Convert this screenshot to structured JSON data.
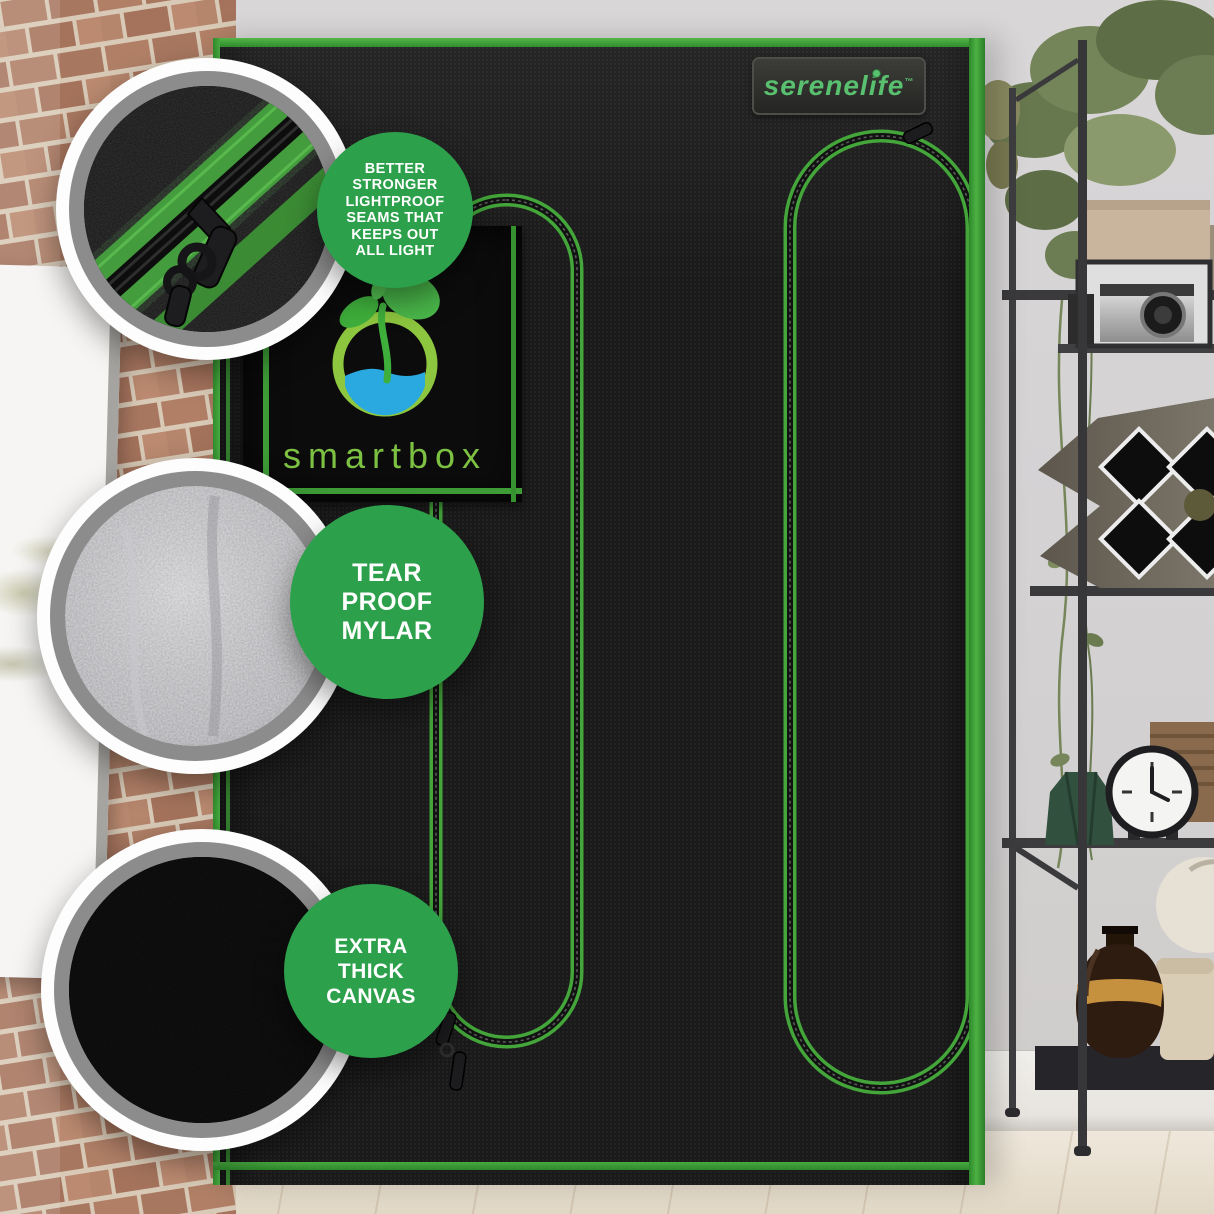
{
  "image_type": "product-marketing-photo",
  "brand": {
    "logo_text": "serenelife",
    "trademark": "™"
  },
  "tent_patch": {
    "logo_text": "smartbox",
    "icon": "plant-sprout-in-ring-icon"
  },
  "callouts": [
    {
      "id": "lightproof-seams",
      "swatch": "zipper-seam-closeup",
      "lines": [
        "BETTER",
        "STRONGER",
        "LIGHTPROOF",
        "SEAMS THAT",
        "KEEPS OUT",
        "ALL LIGHT"
      ]
    },
    {
      "id": "tear-proof-mylar",
      "swatch": "silver-mylar-texture",
      "lines": [
        "TEAR",
        "PROOF",
        "MYLAR"
      ]
    },
    {
      "id": "extra-thick-canvas",
      "swatch": "black-canvas-texture",
      "lines": [
        "EXTRA",
        "THICK",
        "CANVAS"
      ]
    }
  ],
  "colors": {
    "callout_green": "#2da04b",
    "tent_trim_green": "#3fa338",
    "zipper_tape_green": "#4fae44",
    "logo_text_green": "#7cc142",
    "serenelife_green": "#58c06e",
    "water_blue": "#2aa9e0",
    "tent_fabric_black": "#1a1a1a",
    "wall_gray": "#d6d4d5",
    "mylar_silver": "#c3c3c6",
    "brick_red": "#b08066"
  }
}
